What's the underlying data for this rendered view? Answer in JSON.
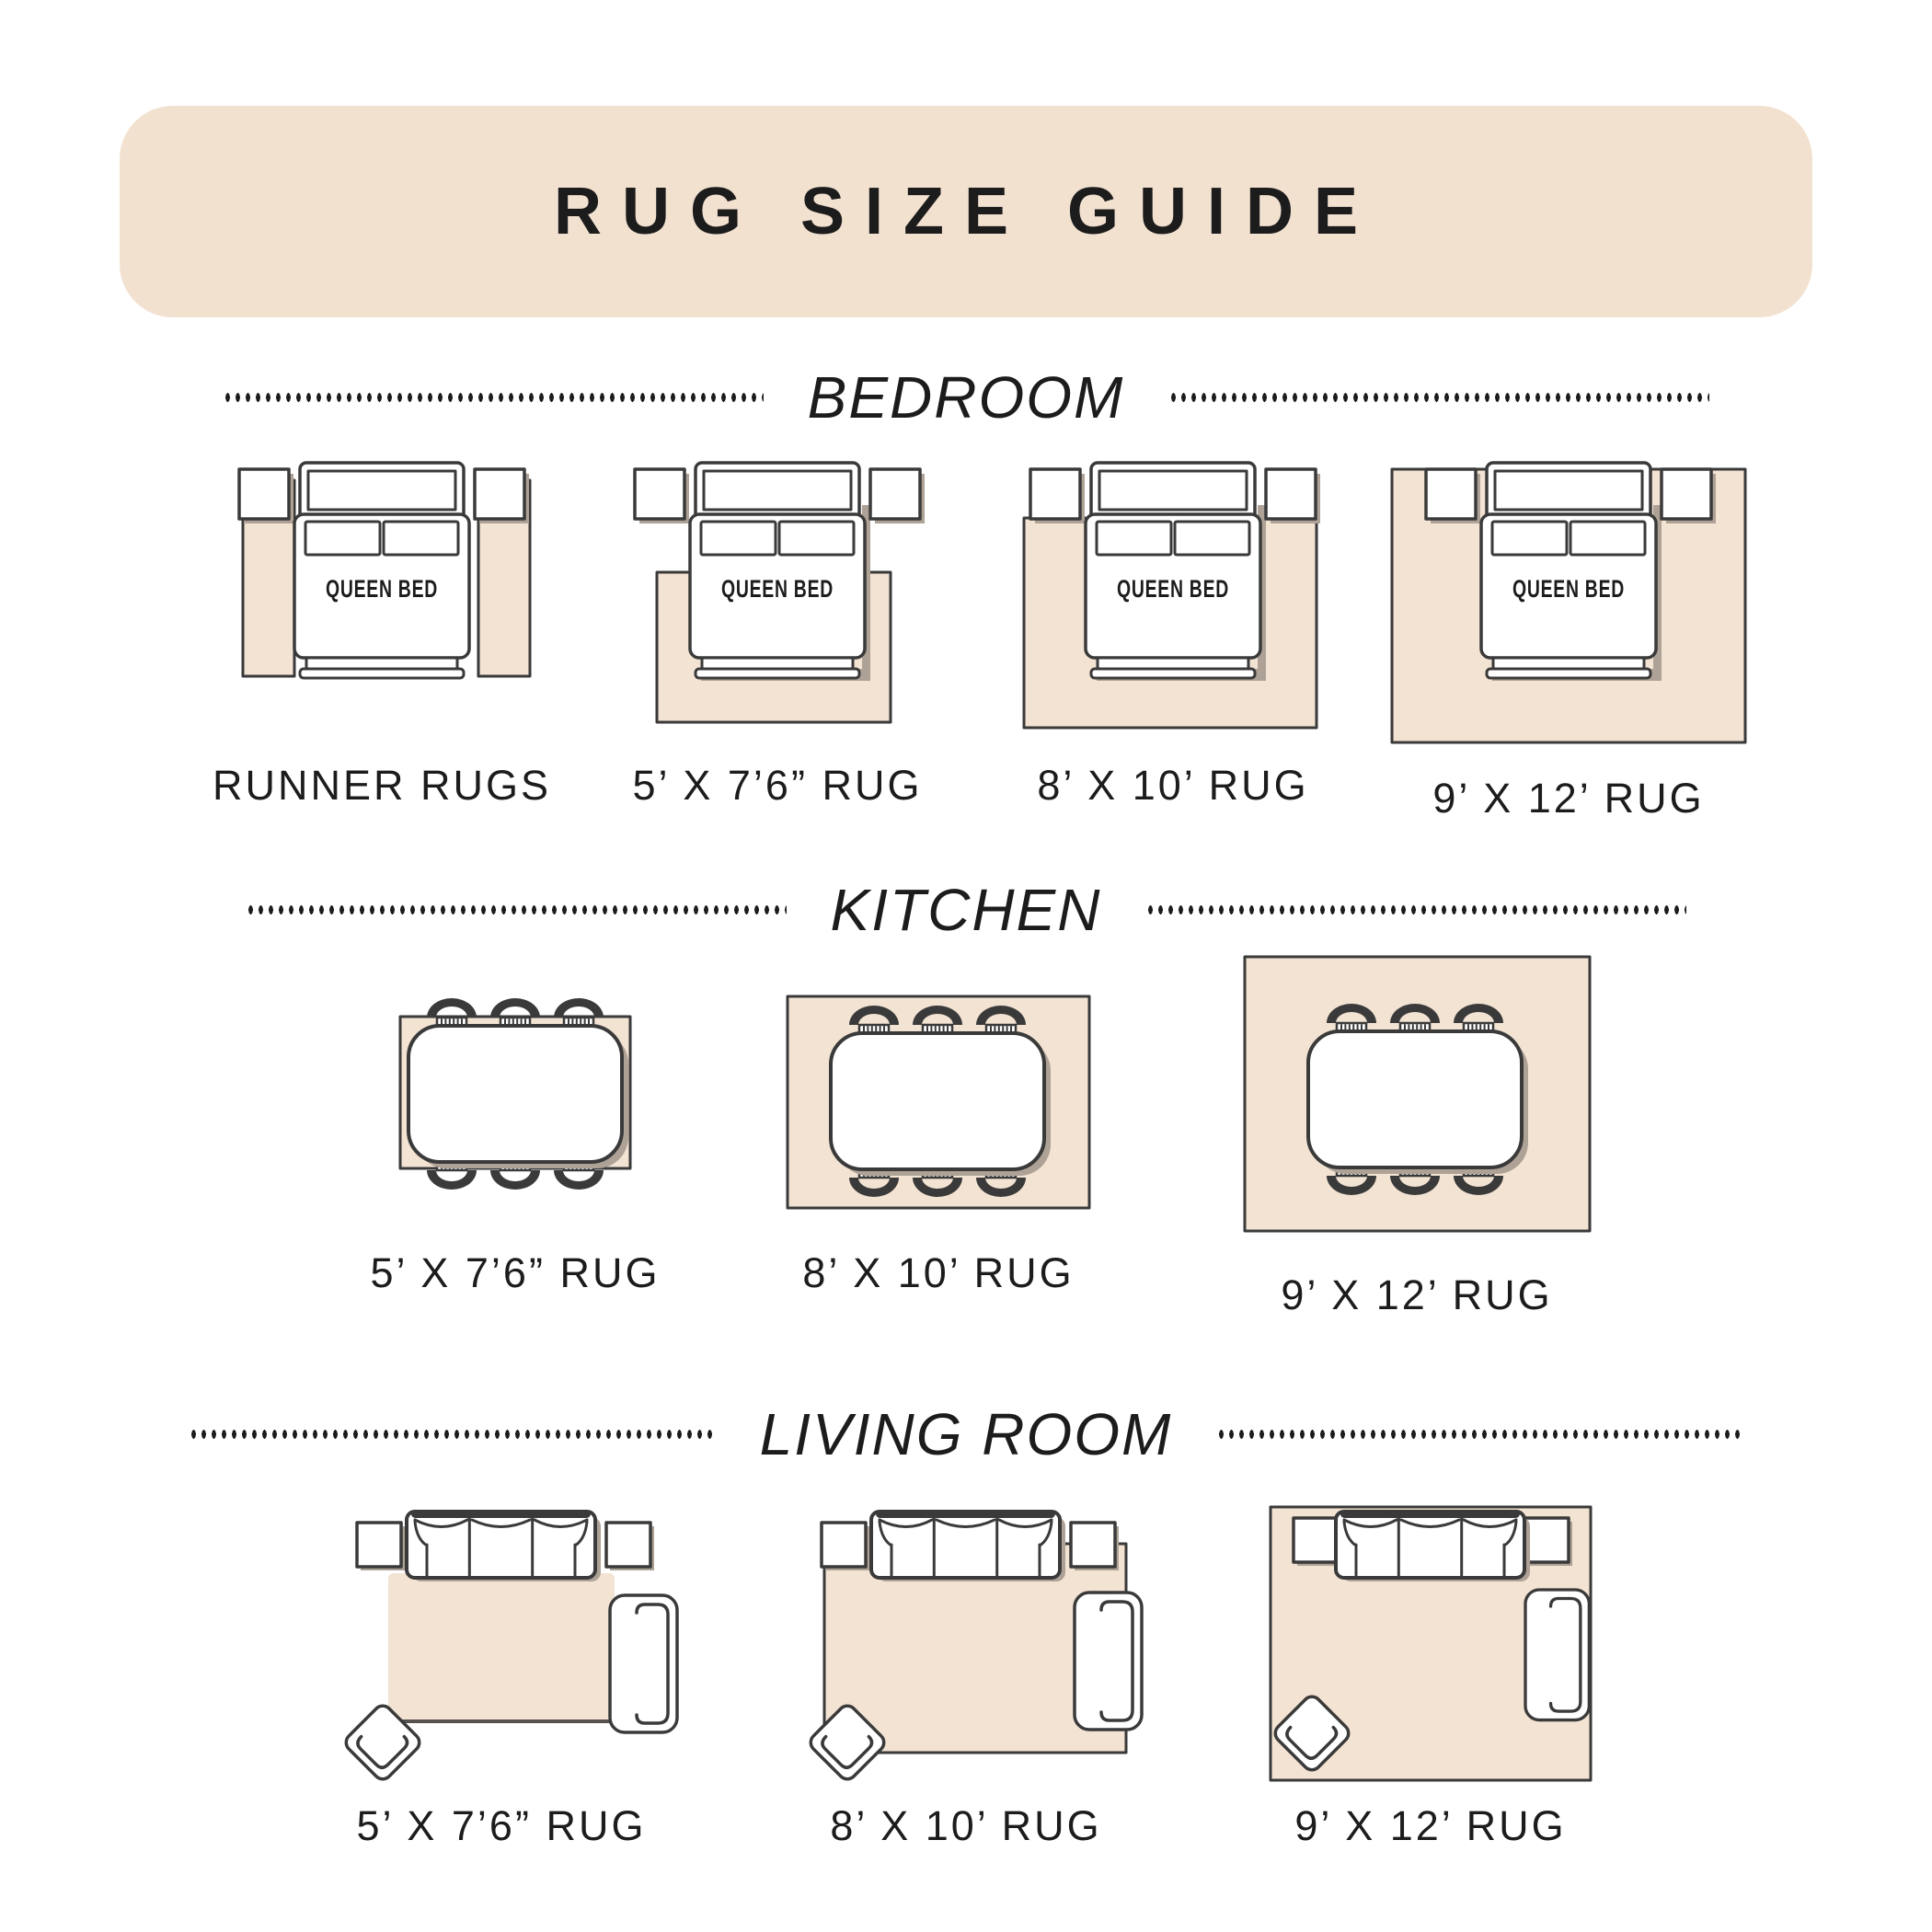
{
  "title": "RUG SIZE GUIDE",
  "colors": {
    "banner": "#f3e1d0",
    "rug": "#f3e3d3",
    "outline": "#3a3a3a",
    "shadow": "#aea297",
    "text": "#1c1c1c"
  },
  "sections": [
    {
      "id": "bedroom",
      "heading": "BEDROOM",
      "items": [
        {
          "label": "RUNNER RUGS",
          "bed_label": "QUEEN BED"
        },
        {
          "label": "5’ X 7’6” RUG",
          "bed_label": "QUEEN BED"
        },
        {
          "label": "8’ X 10’ RUG",
          "bed_label": "QUEEN BED"
        },
        {
          "label": "9’ X 12’ RUG",
          "bed_label": "QUEEN BED"
        }
      ]
    },
    {
      "id": "kitchen",
      "heading": "KITCHEN",
      "items": [
        {
          "label": "5’ X 7’6” RUG"
        },
        {
          "label": "8’ X 10’ RUG"
        },
        {
          "label": "9’ X 12’ RUG"
        }
      ]
    },
    {
      "id": "living-room",
      "heading": "LIVING ROOM",
      "items": [
        {
          "label": "5’ X 7’6” RUG"
        },
        {
          "label": "8’ X 10’ RUG"
        },
        {
          "label": "9’ X 12’ RUG"
        }
      ]
    }
  ]
}
